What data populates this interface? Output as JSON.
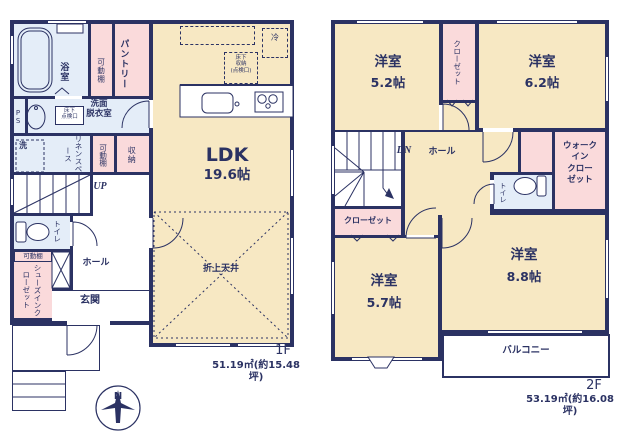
{
  "floor1": {
    "floor_label": "1F",
    "area": "51.19㎡(約15.48坪)",
    "ldk": "LDK",
    "ldk_size": "19.6帖",
    "bath": "浴室",
    "shelf_bath": "可動棚",
    "pantry": "パントリー",
    "ps": "PS",
    "underfloor_hatch": "床下\n点検口",
    "washroom": "洗面\n脱衣室",
    "washer": "洗",
    "linen": "リネンスペース",
    "shelf_linen": "可動棚",
    "storage": "収納",
    "up": "UP",
    "toilet": "トイレ",
    "shelf_shoes": "可動棚",
    "shoes_closet": "シューズインクローゼット",
    "hall": "ホール",
    "entrance": "玄関",
    "fridge": "冷",
    "underfloor_storage": "床下\n収納\n(点検口)",
    "raised_ceiling": "折上天井"
  },
  "floor2": {
    "floor_label": "2F",
    "area": "53.19㎡(約16.08坪)",
    "room_52": "洋室",
    "room_52_size": "5.2帖",
    "room_62": "洋室",
    "room_62_size": "6.2帖",
    "room_57": "洋室",
    "room_57_size": "5.7帖",
    "room_88": "洋室",
    "room_88_size": "8.8帖",
    "closet_top": "クローゼット",
    "closet_left": "クローゼット",
    "dn": "DN",
    "hall": "ホール",
    "toilet": "トイレ",
    "walk_in_closet": "ウォーク\nイン\nクロー\nゼット",
    "balcony": "バルコニー"
  },
  "compass": {
    "north": "N"
  },
  "colors": {
    "wall": "#2b3263",
    "room": "#f7e8c3",
    "closet": "#fadadb",
    "wet": "#e4edf8"
  }
}
